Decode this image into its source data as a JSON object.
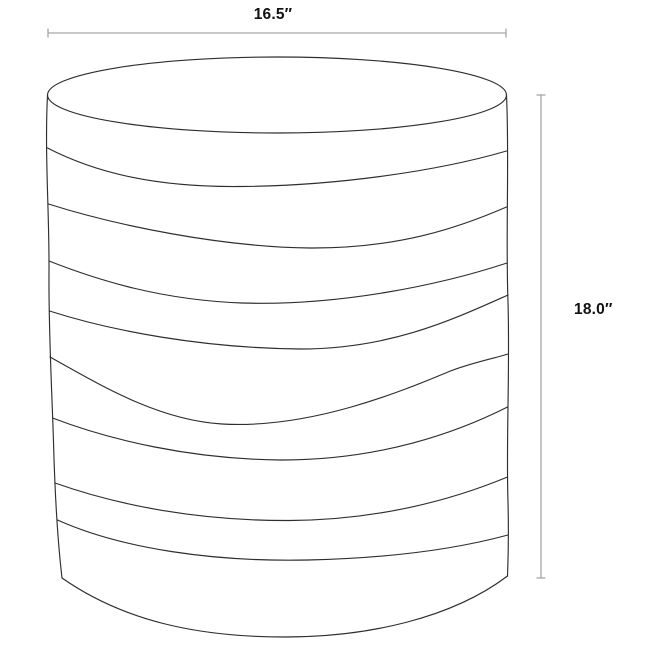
{
  "diagram": {
    "kind": "furniture-dimension-line-drawing",
    "width_dimension": {
      "label": "16.5″"
    },
    "height_dimension": {
      "label": "18.0″"
    },
    "colors": {
      "background": "#ffffff",
      "dimension_line": "#a6a6a6",
      "outline": "#2e2e2e",
      "label_text": "#121212"
    }
  }
}
